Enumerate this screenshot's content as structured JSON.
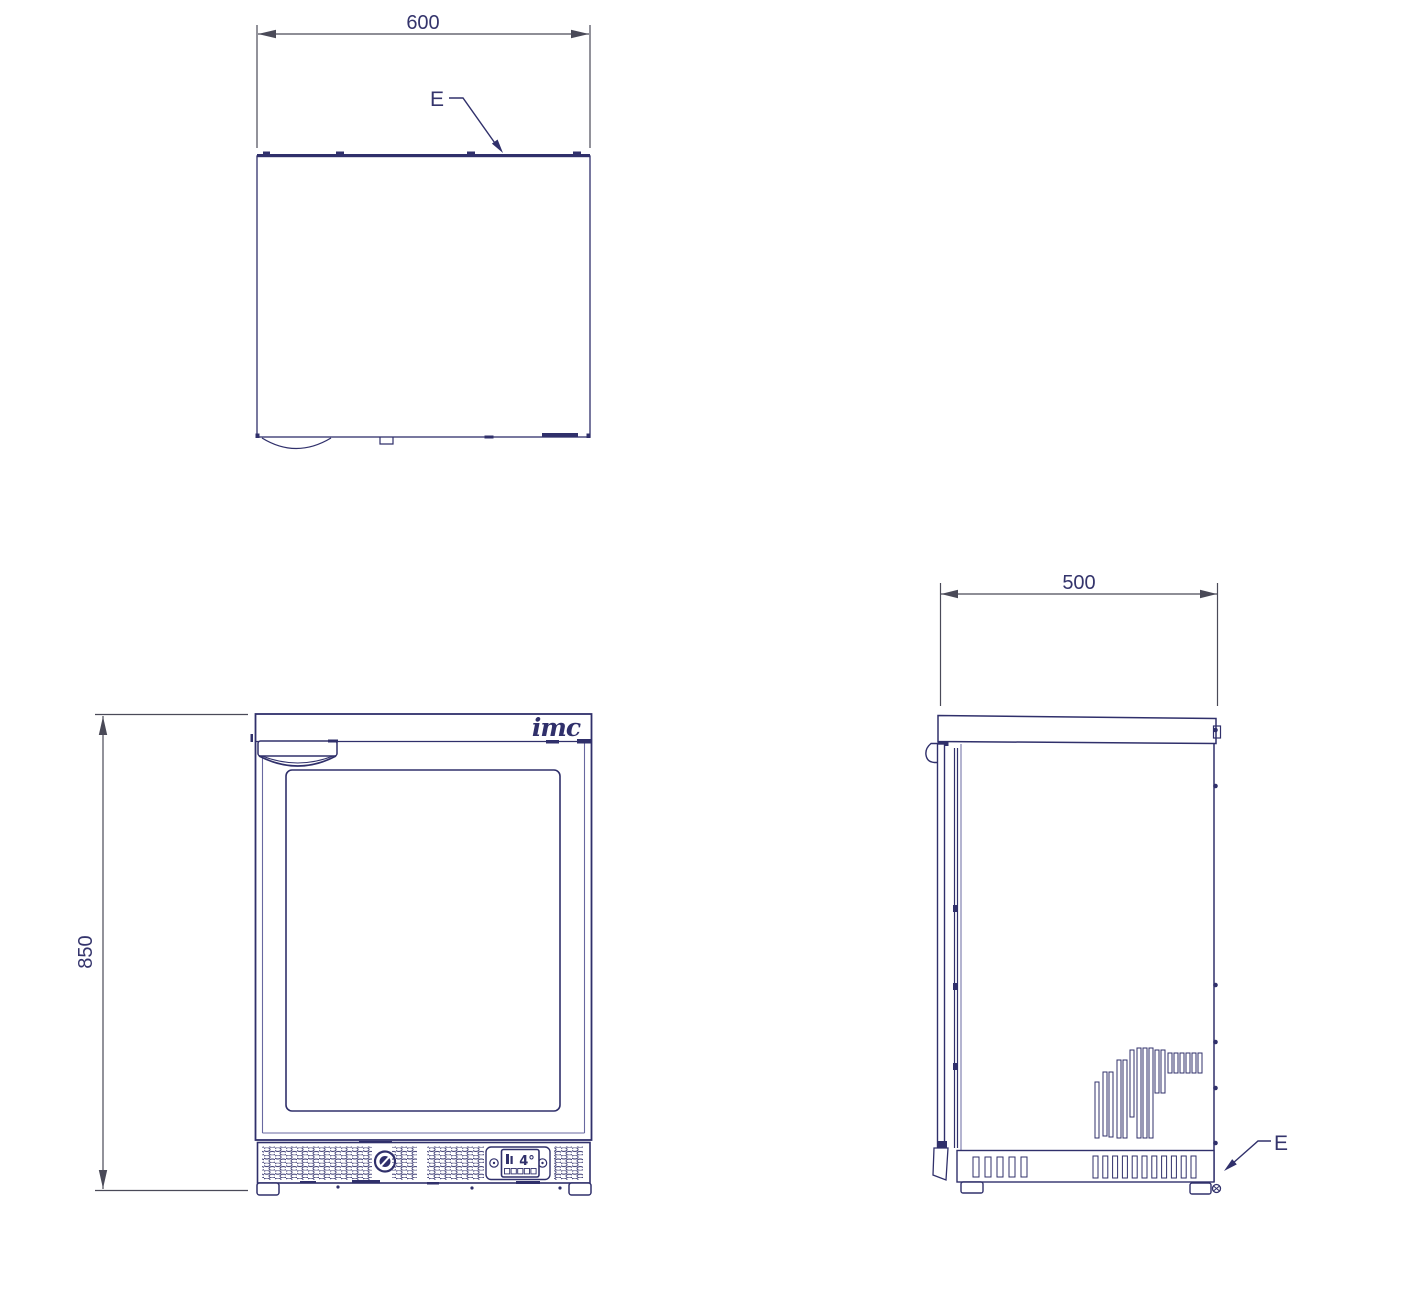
{
  "sheet": {
    "background": "#ffffff"
  },
  "colors": {
    "line": "#30306b",
    "line_light": "#6868a0",
    "dimension_line": "#4a4a58",
    "dimension_text": "#34346c"
  },
  "top_view": {
    "width_dim": "600",
    "detail_label": "E"
  },
  "front_view": {
    "height_dim": "850",
    "brand_logo": "imc",
    "display_temp": "4°"
  },
  "side_view": {
    "depth_dim": "500",
    "detail_label": "E"
  }
}
